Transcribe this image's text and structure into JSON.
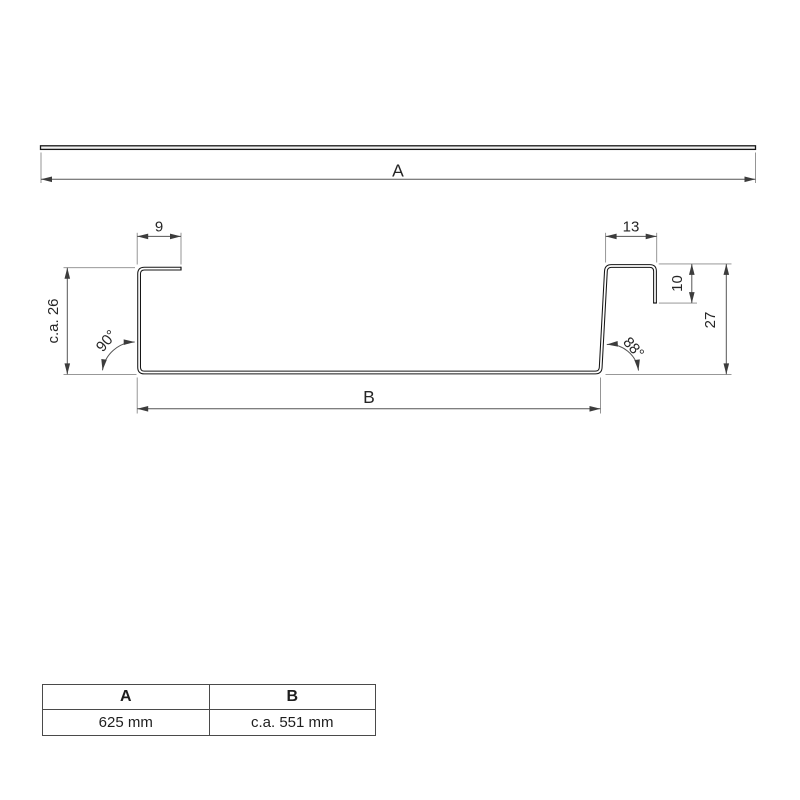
{
  "drawing": {
    "labels": {
      "overall_length": "A",
      "base_width": "B",
      "left_lip_width": "9",
      "right_lip_width": "13",
      "right_return_height": "10",
      "left_leg_height": "c.a. 26",
      "right_leg_height": "27",
      "left_angle": "90°",
      "right_angle": "88°"
    }
  },
  "table": {
    "headers": [
      "A",
      "B"
    ],
    "rows": [
      [
        "625 mm",
        "c.a. 551 mm"
      ]
    ]
  }
}
